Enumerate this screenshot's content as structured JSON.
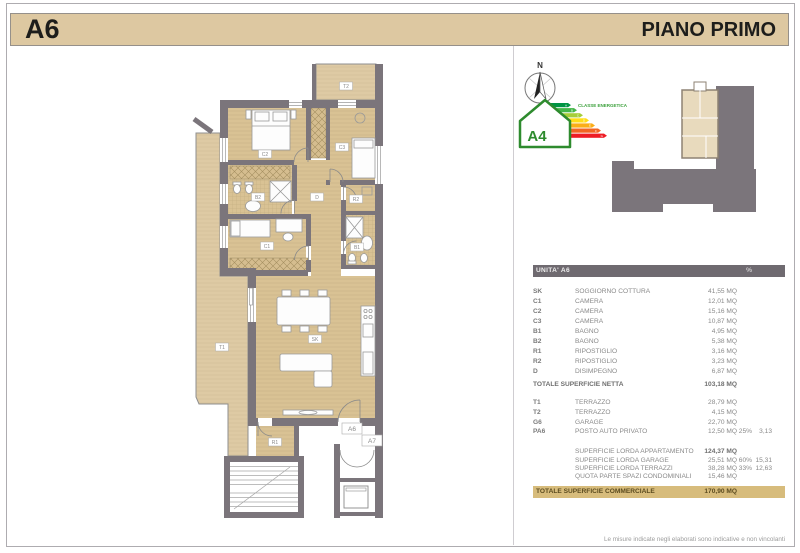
{
  "header": {
    "unit": "A6",
    "floor_title": "PIANO PRIMO"
  },
  "compass": {
    "north_label": "N"
  },
  "energy": {
    "title": "CLASSE ENERGETICA",
    "class_label": "A4",
    "scale_letters": [
      "A",
      "B",
      "C",
      "D",
      "E",
      "F",
      "G"
    ],
    "scale_colors": [
      "#009444",
      "#44b649",
      "#a6ce39",
      "#ffde17",
      "#fbae17",
      "#f26522",
      "#ee1c25"
    ]
  },
  "plan": {
    "room_labels": {
      "t2": "T2",
      "c2": "C2",
      "c3": "C3",
      "b2": "B2",
      "d": "D",
      "r2": "R2",
      "b1": "B1",
      "c1": "C1",
      "sk": "SK",
      "t1": "T1",
      "r1": "R1"
    },
    "door_labels": {
      "a6": "A6",
      "a7": "A7"
    }
  },
  "table": {
    "title": "UNITA' A6",
    "pct_header": "%",
    "rooms": [
      {
        "code": "SK",
        "label": "SOGGIORNO COTTURA",
        "value": "41,55 MQ"
      },
      {
        "code": "C1",
        "label": "CAMERA",
        "value": "12,01 MQ"
      },
      {
        "code": "C2",
        "label": "CAMERA",
        "value": "15,16 MQ"
      },
      {
        "code": "C3",
        "label": "CAMERA",
        "value": "10,87 MQ"
      },
      {
        "code": "B1",
        "label": "BAGNO",
        "value": "4,95 MQ"
      },
      {
        "code": "B2",
        "label": "BAGNO",
        "value": "5,38 MQ"
      },
      {
        "code": "R1",
        "label": "RIPOSTIGLIO",
        "value": "3,16 MQ"
      },
      {
        "code": "R2",
        "label": "RIPOSTIGLIO",
        "value": "3,23 MQ"
      },
      {
        "code": "D",
        "label": "DISIMPEGNO",
        "value": "6,87 MQ"
      }
    ],
    "total_net": {
      "label": "TOTALE SUPERFICIE NETTA",
      "value": "103,18 MQ"
    },
    "annexes": [
      {
        "code": "T1",
        "label": "TERRAZZO",
        "value": "28,79 MQ",
        "pct": "",
        "share": ""
      },
      {
        "code": "T2",
        "label": "TERRAZZO",
        "value": "4,15 MQ",
        "pct": "",
        "share": ""
      },
      {
        "code": "G6",
        "label": "GARAGE",
        "value": "22,70 MQ",
        "pct": "",
        "share": ""
      },
      {
        "code": "PA6",
        "label": "POSTO AUTO PRIVATO",
        "value": "12,50 MQ",
        "pct": "25%",
        "share": "3,13"
      }
    ],
    "gross": [
      {
        "label": "SUPERFICIE LORDA APPARTAMENTO",
        "value": "124,37 MQ",
        "pct": "",
        "share": ""
      },
      {
        "label": "SUPERFICIE LORDA GARAGE",
        "value": "25,51 MQ",
        "pct": "60%",
        "share": "15,31"
      },
      {
        "label": "SUPERFICIE LORDA TERRAZZI",
        "value": "38,28 MQ",
        "pct": "33%",
        "share": "12,63"
      },
      {
        "label": "QUOTA PARTE SPAZI CONDOMINIALI",
        "value": "15,46 MQ",
        "pct": "",
        "share": ""
      }
    ],
    "total_commercial": {
      "label": "TOTALE SUPERFICIE COMMERCIALE",
      "value": "170,90 MQ"
    }
  },
  "footer": {
    "disclaimer": "Le misure indicate negli elaborati sono indicative e non vincolanti"
  },
  "colors": {
    "header_bar": "#ddc8a1",
    "wall": "#7b757b",
    "floor": "#d9c294",
    "terrace": "#decaa4",
    "table_header_bg": "#6f6a70",
    "total_bar_bg": "#d7bc7c",
    "energy_green": "#2e8b2e"
  }
}
